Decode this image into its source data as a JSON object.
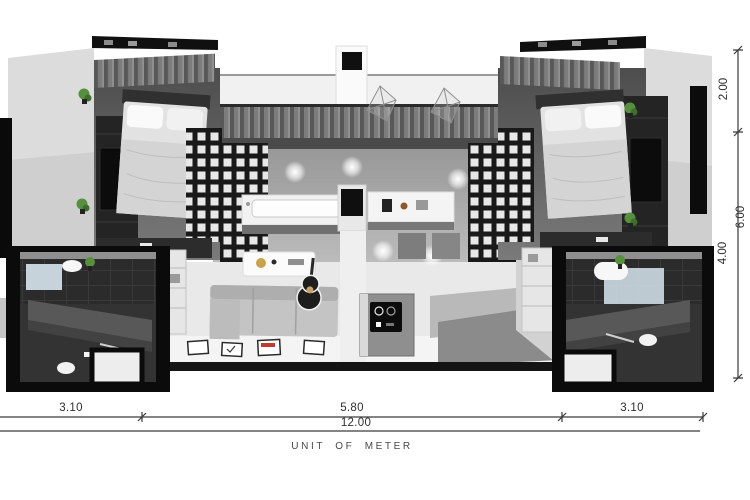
{
  "caption": "UNIT OF METER",
  "dims": {
    "bottom": {
      "seg1": "3.10",
      "seg2": "5.80",
      "seg3": "3.10",
      "total": "12.00"
    },
    "right": {
      "seg1": "2.00",
      "seg2": "6.00",
      "seg3": "4.00"
    }
  },
  "colors": {
    "dim_line": "#3a3a3a",
    "wall_light": "#d9d9d9",
    "wall_dark": "#111111",
    "floor_mid": "#ababab",
    "floor_light": "#e9e9e9",
    "plant_green": "#56903c",
    "accent_red": "#c23b2e",
    "glass_blue": "#d8e6ee"
  }
}
